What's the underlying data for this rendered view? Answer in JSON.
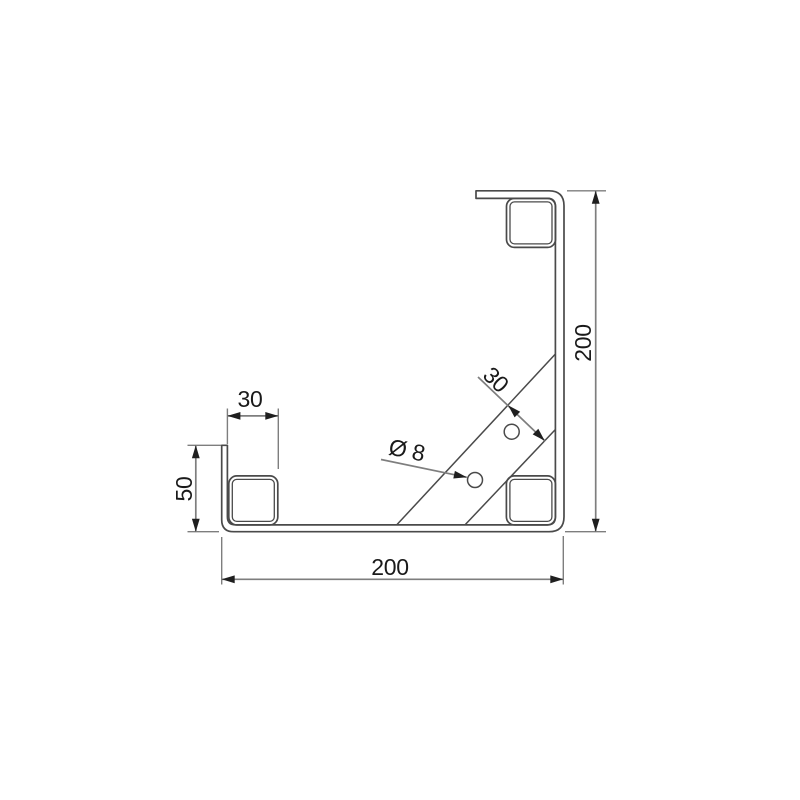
{
  "drawing": {
    "type": "technical-drawing",
    "subject": "corner-bracket-side-view",
    "dimensions": {
      "right_height": "200",
      "bottom_width": "200",
      "left_lip_height": "50",
      "tube_width": "30",
      "brace_width": "30",
      "hole_diameter": "Ø 8"
    },
    "colors": {
      "part_line": "#4a4a4a",
      "dim_line": "#7e7e7e",
      "text": "#1a1a1a",
      "background": "#ffffff"
    }
  }
}
